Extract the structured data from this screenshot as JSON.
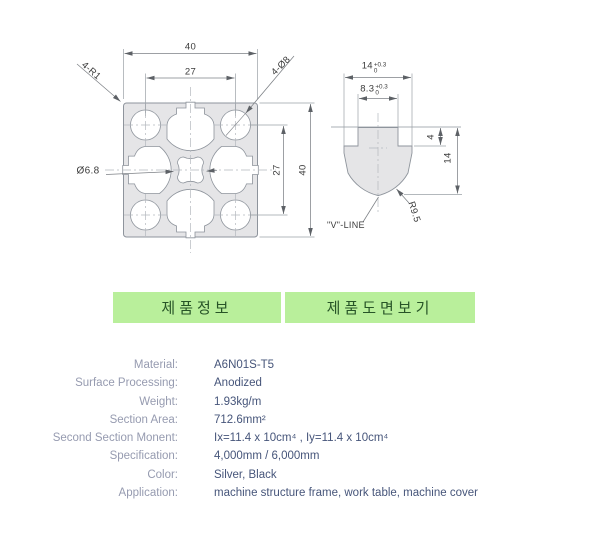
{
  "drawing": {
    "profile": {
      "dim_width_top": "40",
      "dim_pitch_top": "27",
      "label_corner_radius": "4-R1",
      "label_corner_holes": "4-Ø8",
      "label_center_hole": "Ø6.8",
      "dim_pitch_right": "27",
      "dim_height_right": "40"
    },
    "detail": {
      "dim_slot_width": "14",
      "dim_slot_width_tol_plus": "+0.3",
      "dim_slot_width_tol_min": "0",
      "dim_neck_width": "8.3",
      "dim_neck_tol_plus": "+0.3",
      "dim_neck_tol_min": "0",
      "dim_lip_depth": "4",
      "dim_slot_depth": "14",
      "label_radius": "R9.5",
      "label_vline": "\"V\"-LINE"
    }
  },
  "tabs": [
    {
      "label": "제품정보"
    },
    {
      "label": "제품도면보기"
    }
  ],
  "specs": {
    "rows": [
      {
        "label": "Material:",
        "value": "A6N01S-T5"
      },
      {
        "label": "Surface Processing:",
        "value": "Anodized"
      },
      {
        "label": "Weight:",
        "value": "1.93kg/m"
      },
      {
        "label": "Section Area:",
        "value": "712.6mm²"
      },
      {
        "label": "Second Section Monent:",
        "value": "Ix=11.4 x 10cm⁴ , Iy=11.4 x 10cm⁴"
      },
      {
        "label": "Specification:",
        "value": "4,000mm / 6,000mm"
      },
      {
        "label": "Color:",
        "value": "Silver, Black"
      },
      {
        "label": "Application:",
        "value": "machine structure frame, work table, machine cover"
      }
    ]
  },
  "colors": {
    "tab_bg": "#b9ef9b",
    "tab_text": "#275427",
    "spec_label": "#969bb0",
    "spec_value": "#46557a",
    "profile_fill": "#e5e5e7",
    "profile_line": "#8e949c"
  }
}
